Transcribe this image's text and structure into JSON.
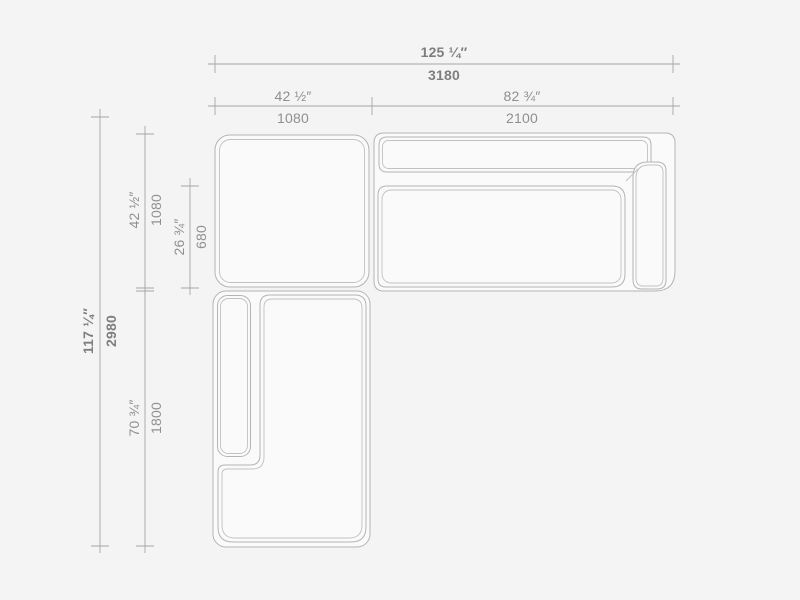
{
  "meta": {
    "title": "Sectional sofa top view dimension drawing"
  },
  "theme": {
    "bg": "#f4f4f5",
    "fill": "#fafafa",
    "line": "#b4b4b4",
    "line-inner": "#c1c1c1",
    "dim-line": "#a6a6a6",
    "text": "#8f8f8f",
    "text-strong": "#7e7e7e"
  },
  "dimensions": {
    "overall_width": {
      "inch": "125 ¼″",
      "mm": "3180"
    },
    "left_width": {
      "inch": "42 ½″",
      "mm": "1080"
    },
    "right_width": {
      "inch": "82 ¾″",
      "mm": "2100"
    },
    "overall_depth": {
      "inch": "117 ¼″",
      "mm": "2980"
    },
    "corner_depth": {
      "inch": "42 ½″",
      "mm": "1080"
    },
    "seat_depth": {
      "inch": "26 ¾″",
      "mm": "680"
    },
    "chaise_length": {
      "inch": "70 ¾″",
      "mm": "1800"
    }
  }
}
